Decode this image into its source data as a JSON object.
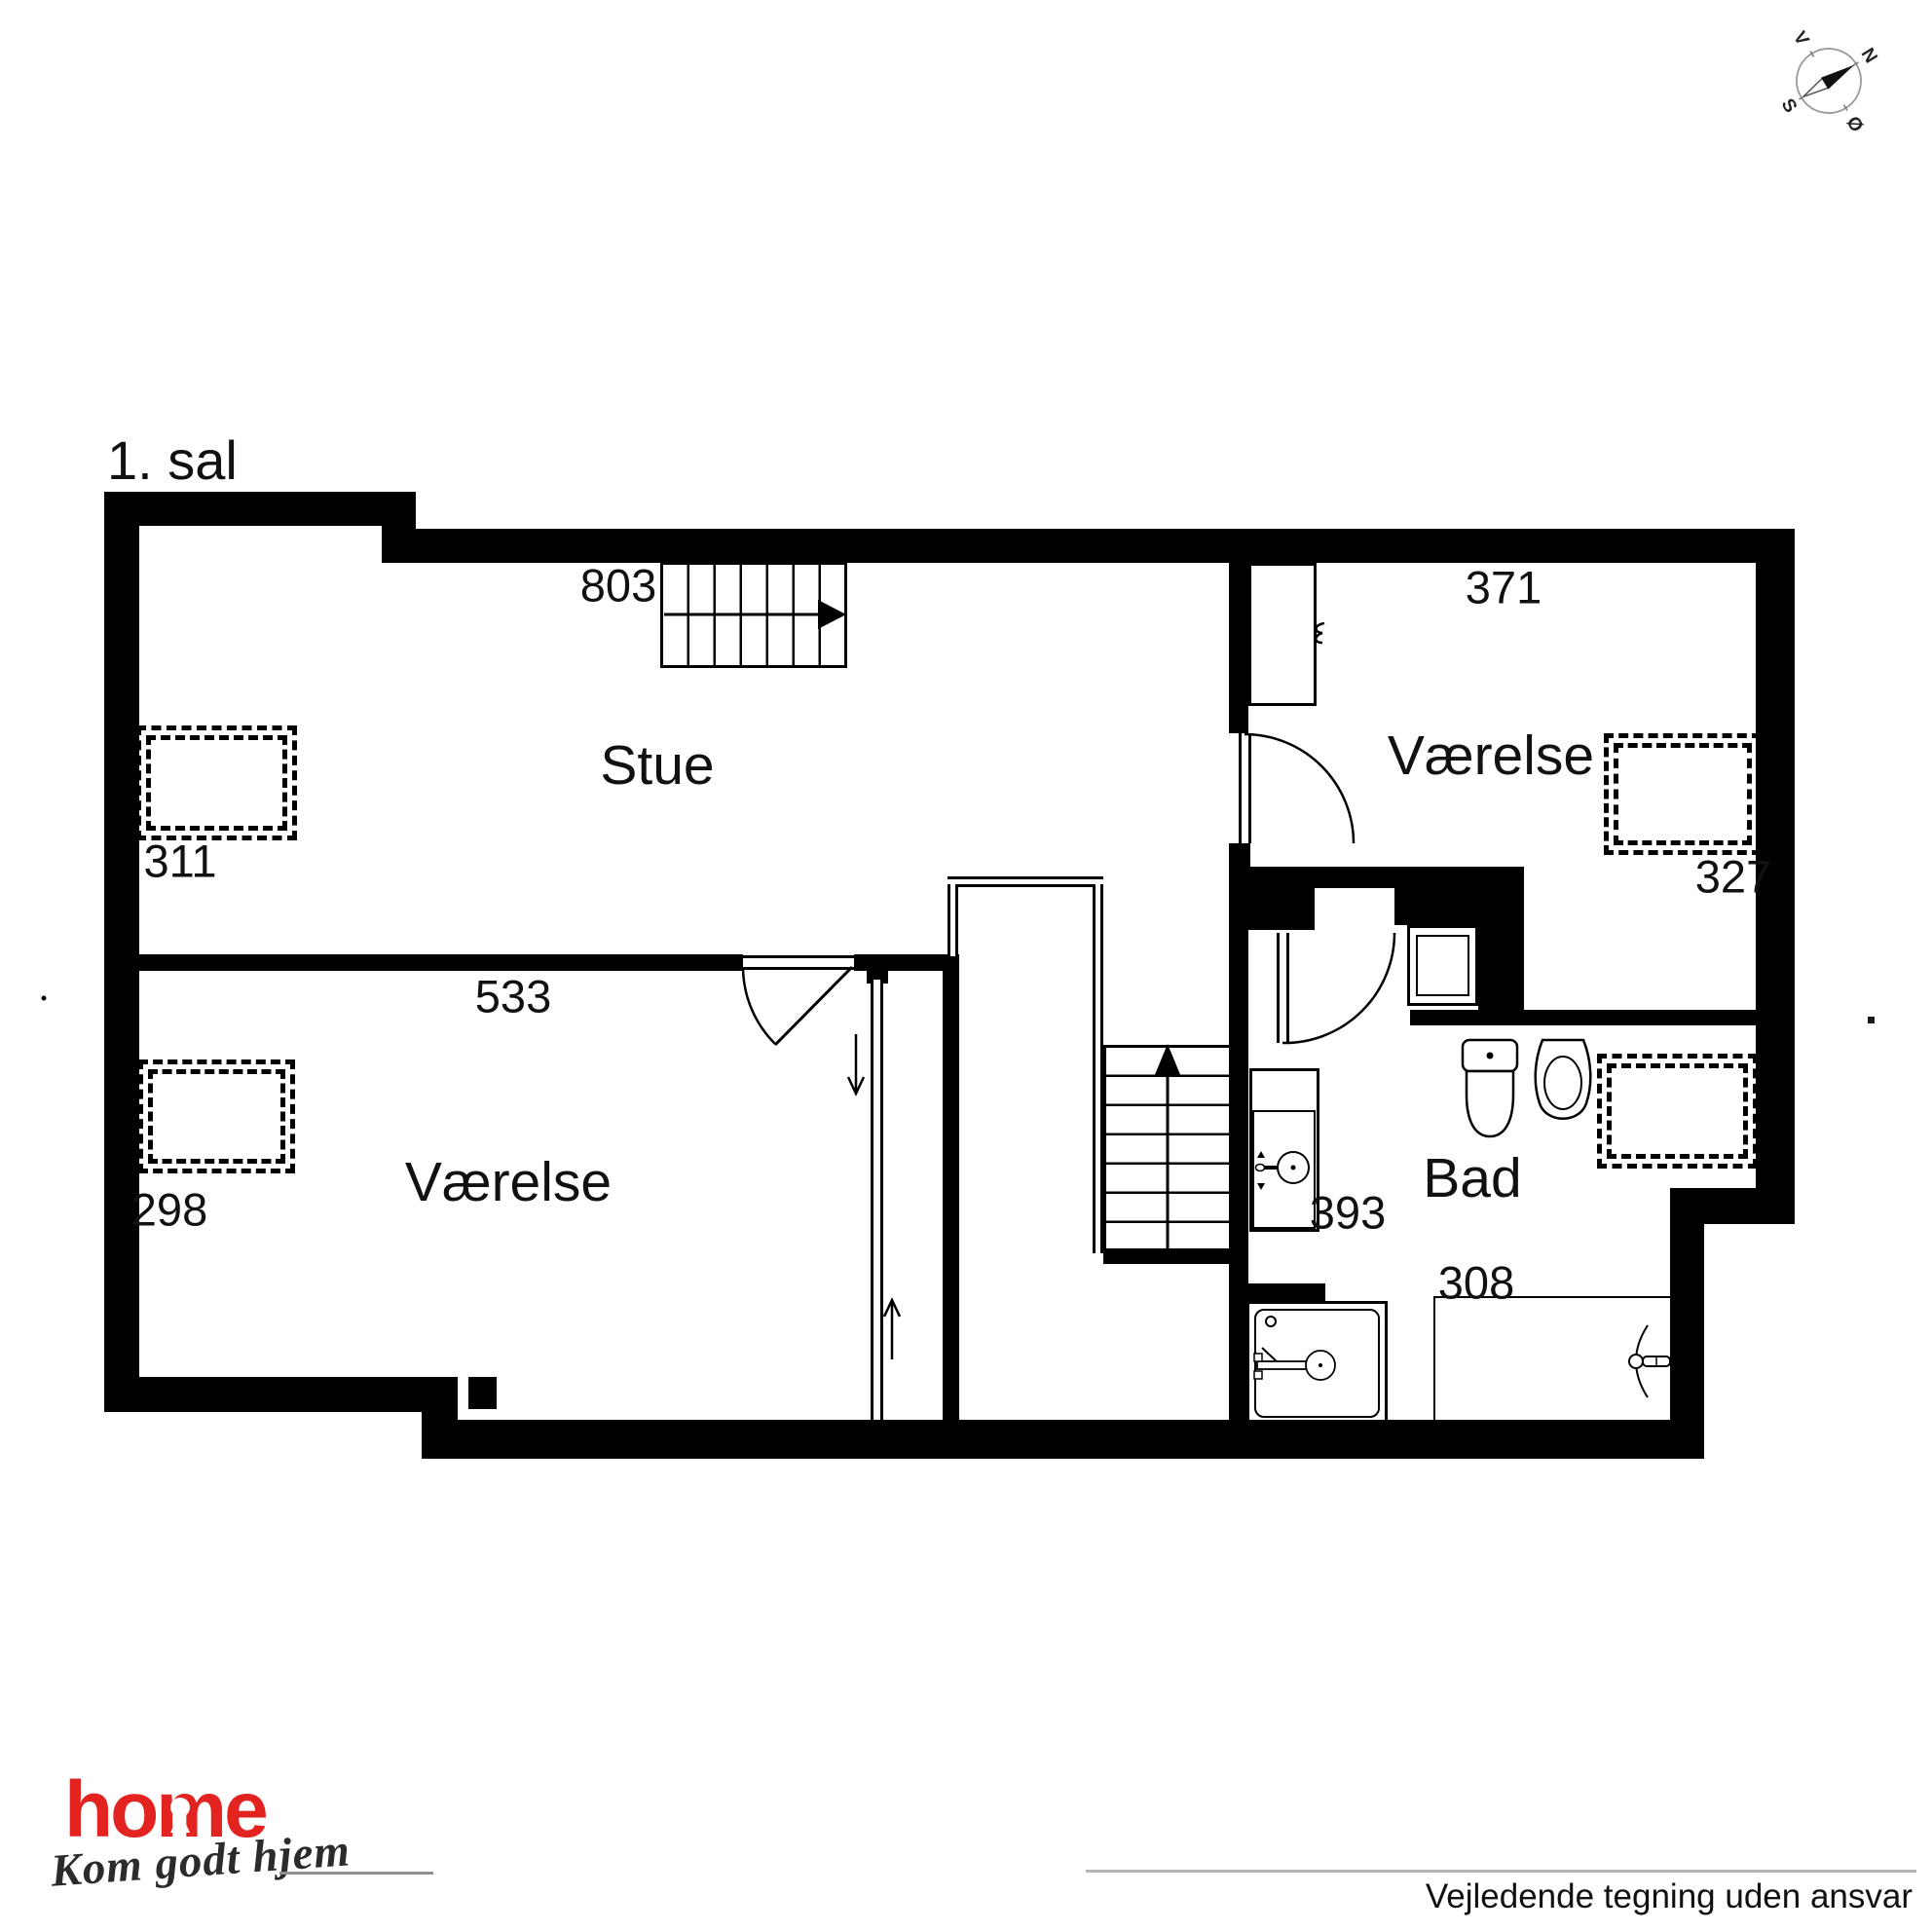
{
  "floor_label": "1. sal",
  "rooms": {
    "living": "Stue",
    "room_right": "Værelse",
    "room_left": "Værelse",
    "bath": "Bad"
  },
  "dimensions": {
    "stairs_top": "803",
    "room_right_width": "371",
    "zone_left_top": "311",
    "zone_right_top": "327",
    "living_width": "533",
    "zone_left_bottom": "298",
    "bath_counter": "393",
    "bath_width": "308"
  },
  "compass": {
    "north": "N",
    "south": "S",
    "east": "Ø",
    "west": "V"
  },
  "branding": {
    "logo_text": "home",
    "tagline": "Kom godt hjem",
    "logo_color": "#e2231f"
  },
  "footer": {
    "disclaimer": "Vejledende tegning uden ansvar"
  }
}
